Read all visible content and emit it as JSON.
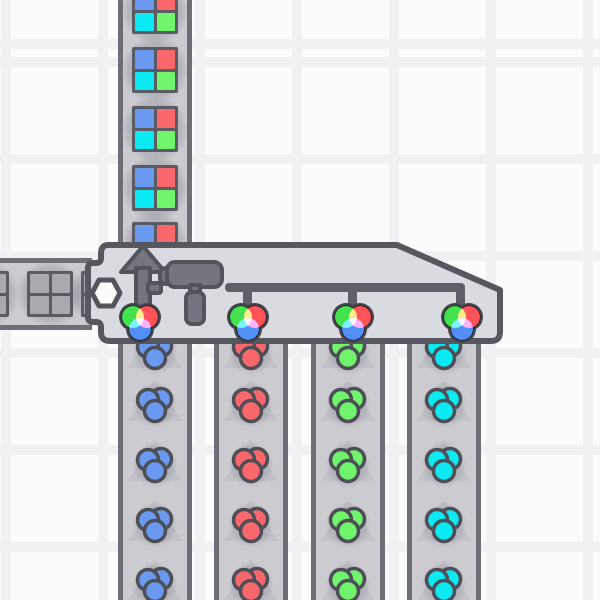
{
  "scene": {
    "game": "factory-builder",
    "description": "quad painter machine with shape input, four color inputs and painted output"
  },
  "palette": {
    "red": "#fb686c",
    "green": "#70f46c",
    "blue": "#6a99f2",
    "cyan": "#0be9f3",
    "uncolored": "#a9a9b0",
    "belt": "#cbcbd0",
    "belt_border": "#6e6e76",
    "belt_arrow": "#c2c2c8",
    "building_fill": "#dadae1",
    "building_border": "#575760",
    "machine_gray": "#75757f",
    "machine_outline": "#54545c",
    "pipe": "#5f5f69",
    "item_frame": "#5b5b63",
    "icon_outline": "#45454e",
    "wheel_red": "#ff5358",
    "wheel_green": "#42e34d",
    "wheel_blue": "#528ff8",
    "hexagon_fill": "#fbfbfc",
    "background_cell": "#fcfcfd",
    "background_line": "#f1f1f4"
  },
  "building": {
    "name": "quad-painter",
    "direction": "up",
    "parts": [
      "up-arrow-icon",
      "paint-roller-icon",
      "pipe-manifold",
      "shape-input-hexagon"
    ],
    "bounds": {
      "left": 88,
      "top": 244,
      "right": 500,
      "bottom": 341
    }
  },
  "output_belt": {
    "direction": "up",
    "x_left": 118,
    "height": 250,
    "item": "window-painted-4color",
    "window_colors": [
      "blue",
      "red",
      "cyan",
      "green"
    ],
    "items_y": [
      11,
      70,
      129,
      188,
      245
    ]
  },
  "shape_input_belt": {
    "direction": "right",
    "y_top": 258,
    "width": 92,
    "item": "window-uncolored",
    "items_x": [
      -14,
      50,
      104
    ]
  },
  "color_input_belts": {
    "direction": "up",
    "y_top": 336,
    "height": 264,
    "colors": [
      "blue",
      "red",
      "green",
      "cyan"
    ],
    "x_centers": [
      155,
      251,
      348,
      444
    ],
    "blob_y": [
      352,
      405,
      465,
      525,
      585
    ],
    "arrow_tip_offset": -26
  },
  "input_icons": {
    "name": "color-wheel-icon",
    "count": 4,
    "x_centers": [
      140,
      248,
      353,
      462
    ],
    "y_top": 300
  }
}
